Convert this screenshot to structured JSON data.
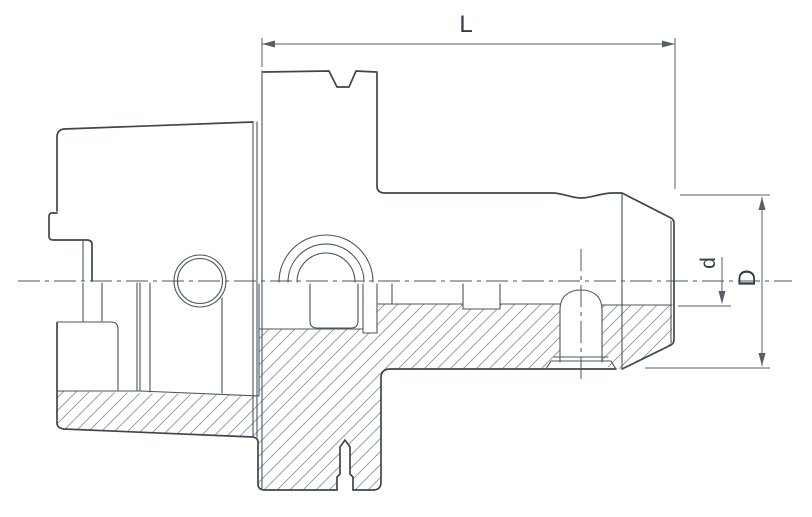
{
  "drawing": {
    "kind": "tool-holder-technical-cross-section",
    "dimensions": {
      "length_label": "L",
      "bore_diameter_label": "d",
      "outer_diameter_label": "D"
    },
    "colors": {
      "outline": "#3d4651",
      "thin_line": "#4a5560",
      "hatch": "#8a929c",
      "dimension": "#565f69",
      "text": "#333b44",
      "background": "#ffffff"
    }
  }
}
